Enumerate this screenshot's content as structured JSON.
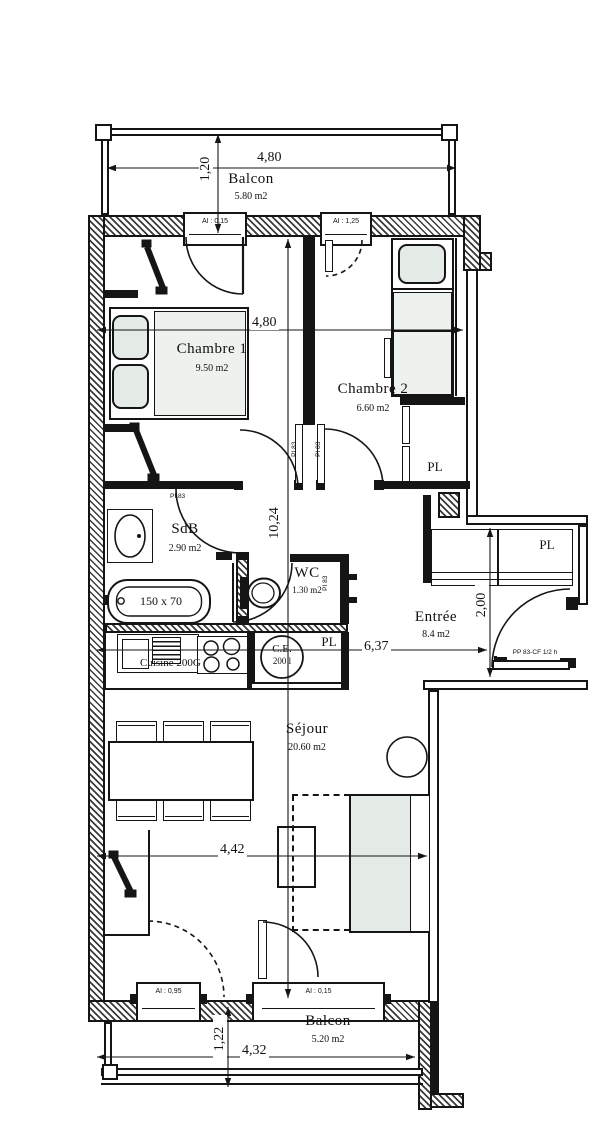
{
  "plan": {
    "balcon_top": {
      "label": "Balcon",
      "area": "5.80 m2"
    },
    "balcon_bottom": {
      "label": "Balcon",
      "area": "5.20 m2"
    },
    "chambre1": {
      "label": "Chambre 1",
      "area": "9.50 m2"
    },
    "chambre2": {
      "label": "Chambre 2",
      "area": "6.60 m2"
    },
    "sdb": {
      "label": "SdB",
      "area": "2.90 m2"
    },
    "wc": {
      "label": "WC",
      "area": "1.30 m2"
    },
    "entree": {
      "label": "Entrée",
      "area": "8.4 m2"
    },
    "sejour": {
      "label": "Séjour",
      "area": "20.60 m2"
    },
    "cuisine": {
      "label": "Cuisine 200G"
    },
    "closet": {
      "label": "PL"
    },
    "water_heater": {
      "abbr": "C.E.",
      "capacity": "200 l"
    },
    "bathtub": {
      "label": "150 x 70"
    },
    "dims": {
      "balcon_top_width": "4,80",
      "balcon_top_depth": "1,20",
      "interior_width": "4,80",
      "interior_length": "10,24",
      "mid_width": "6,37",
      "entree_depth": "2,00",
      "sejour_width": "4,42",
      "balcon_bottom_width": "4,32",
      "balcon_bottom_depth": "1,22"
    },
    "windows": {
      "top_left": "AI : 0,15",
      "top_right": "AI : 1,25",
      "bottom_left": "AI : 0,95",
      "bottom_right": "AI : 0,15"
    },
    "doors": {
      "interior": "PI 83",
      "entrance": "PP 83-CF 1/2 h"
    }
  }
}
